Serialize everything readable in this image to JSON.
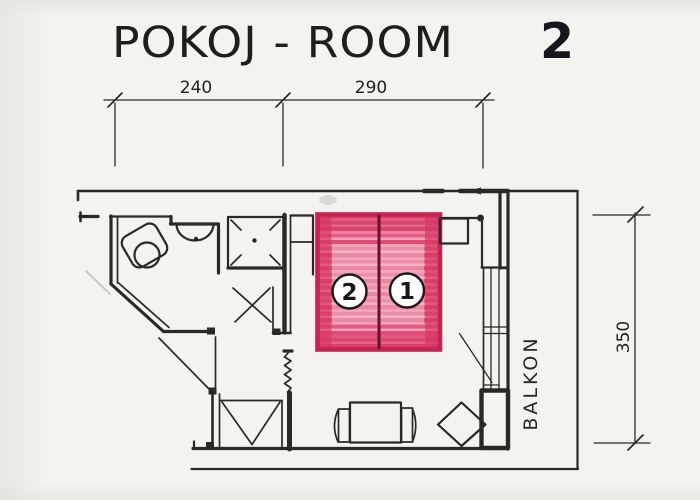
{
  "drawing": {
    "title": "POKOJ - ROOM",
    "room_number": "2",
    "dimensions": {
      "top_left": "240",
      "top_right": "290",
      "right": "350"
    },
    "balcony_label": "BALKON",
    "beds": [
      {
        "number": "2"
      },
      {
        "number": "1"
      }
    ],
    "fixtures": [
      "toilet",
      "washbasin",
      "shower",
      "double-bed",
      "nightstand",
      "wardrobe",
      "table-with-chairs",
      "balcony-door"
    ],
    "colors": {
      "ink": "#2b2927",
      "bed_fill": "#e75f86",
      "bed_border": "#c4244f",
      "bed_divider": "#6b1029",
      "paper": "#f4f3f0"
    }
  }
}
